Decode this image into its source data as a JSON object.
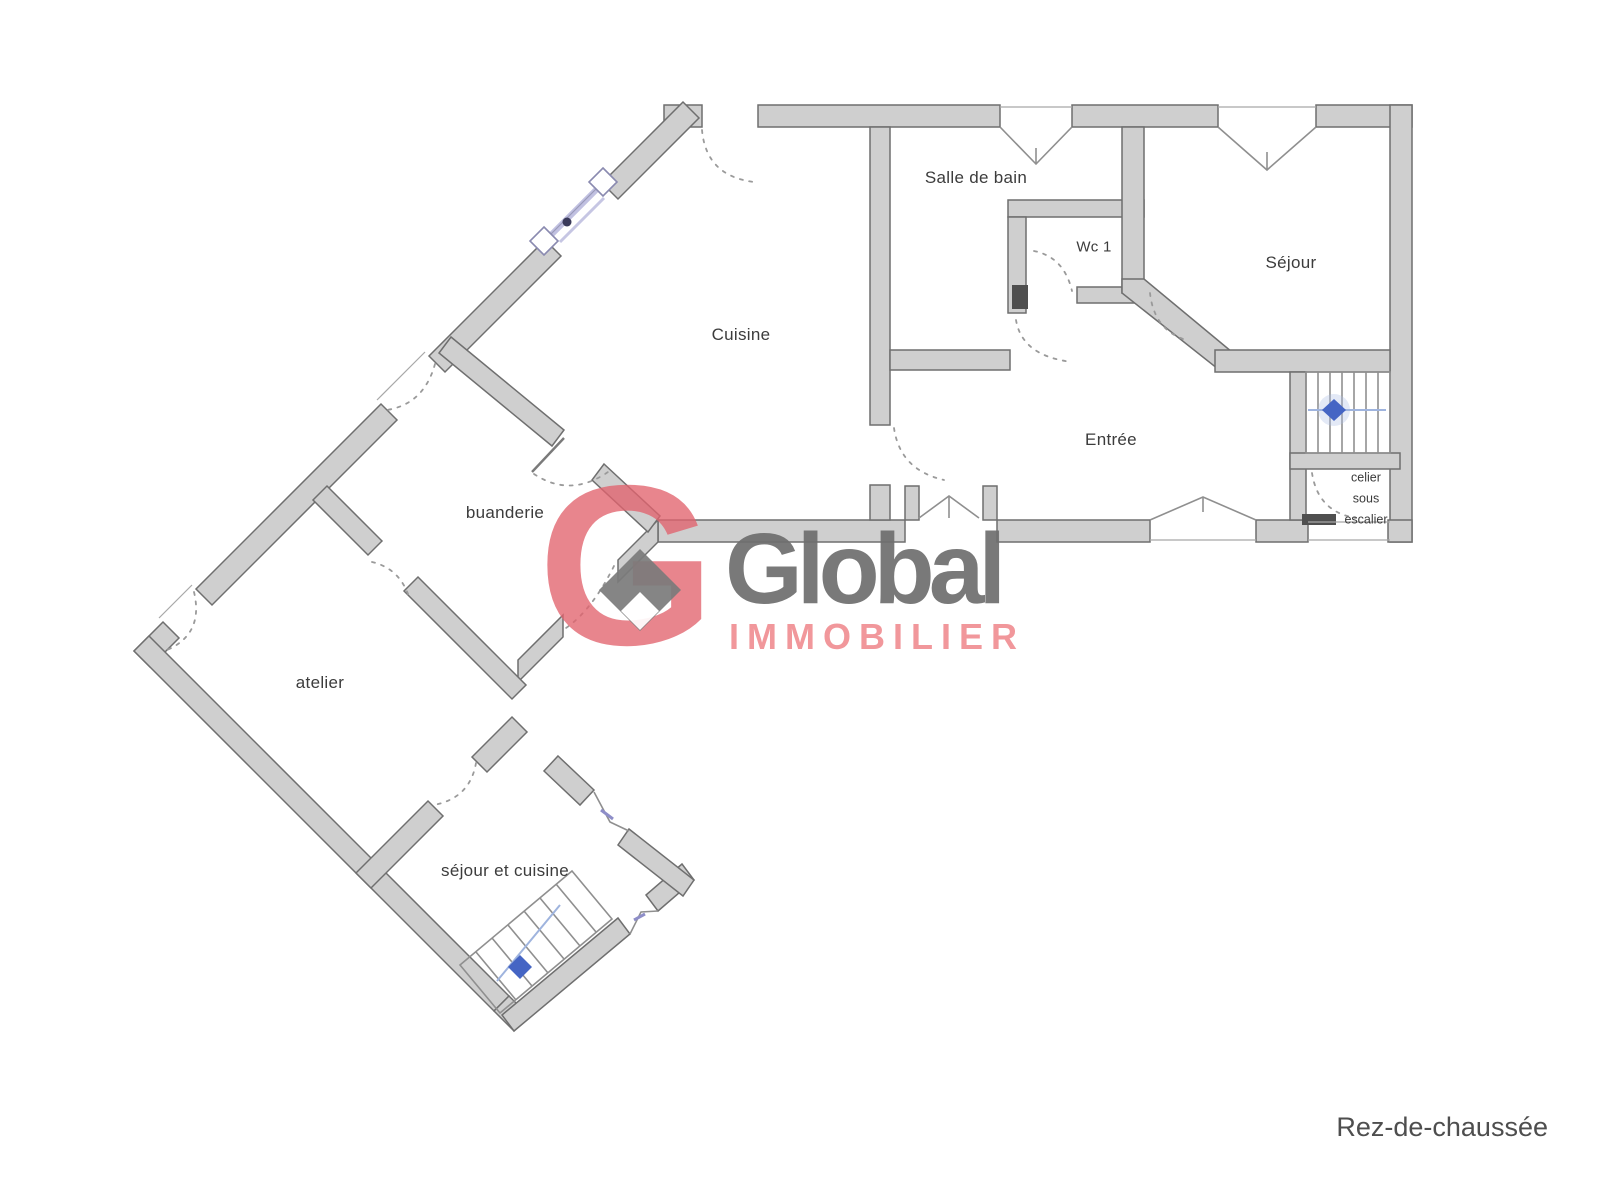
{
  "floor_plan": {
    "rooms": {
      "salle_de_bain": "Salle de bain",
      "wc": "Wc 1",
      "sejour": "Séjour",
      "cuisine": "Cuisine",
      "entree": "Entrée",
      "buanderie": "buanderie",
      "atelier": "atelier",
      "sejour_et_cuisine": "séjour et cuisine"
    },
    "closet": {
      "line1": "celier",
      "line2": "sous",
      "line3": "escalier"
    },
    "floor_label": "Rez-de-chaussée"
  },
  "watermark": {
    "monogram": "G",
    "brand": "Global",
    "subtitle": "IMMOBILIER",
    "accent_color": "#e2636e",
    "brand_color": "#6f6f6f",
    "subtitle_color": "#f19296"
  },
  "drawing": {
    "wall_fill": "#cfcfcf",
    "wall_outline": "#6f6f6f",
    "door_arc_color": "#9a9a9a",
    "window_accent_color": "#8e8ec8",
    "stairs_arrow_color": "#4565c4"
  }
}
